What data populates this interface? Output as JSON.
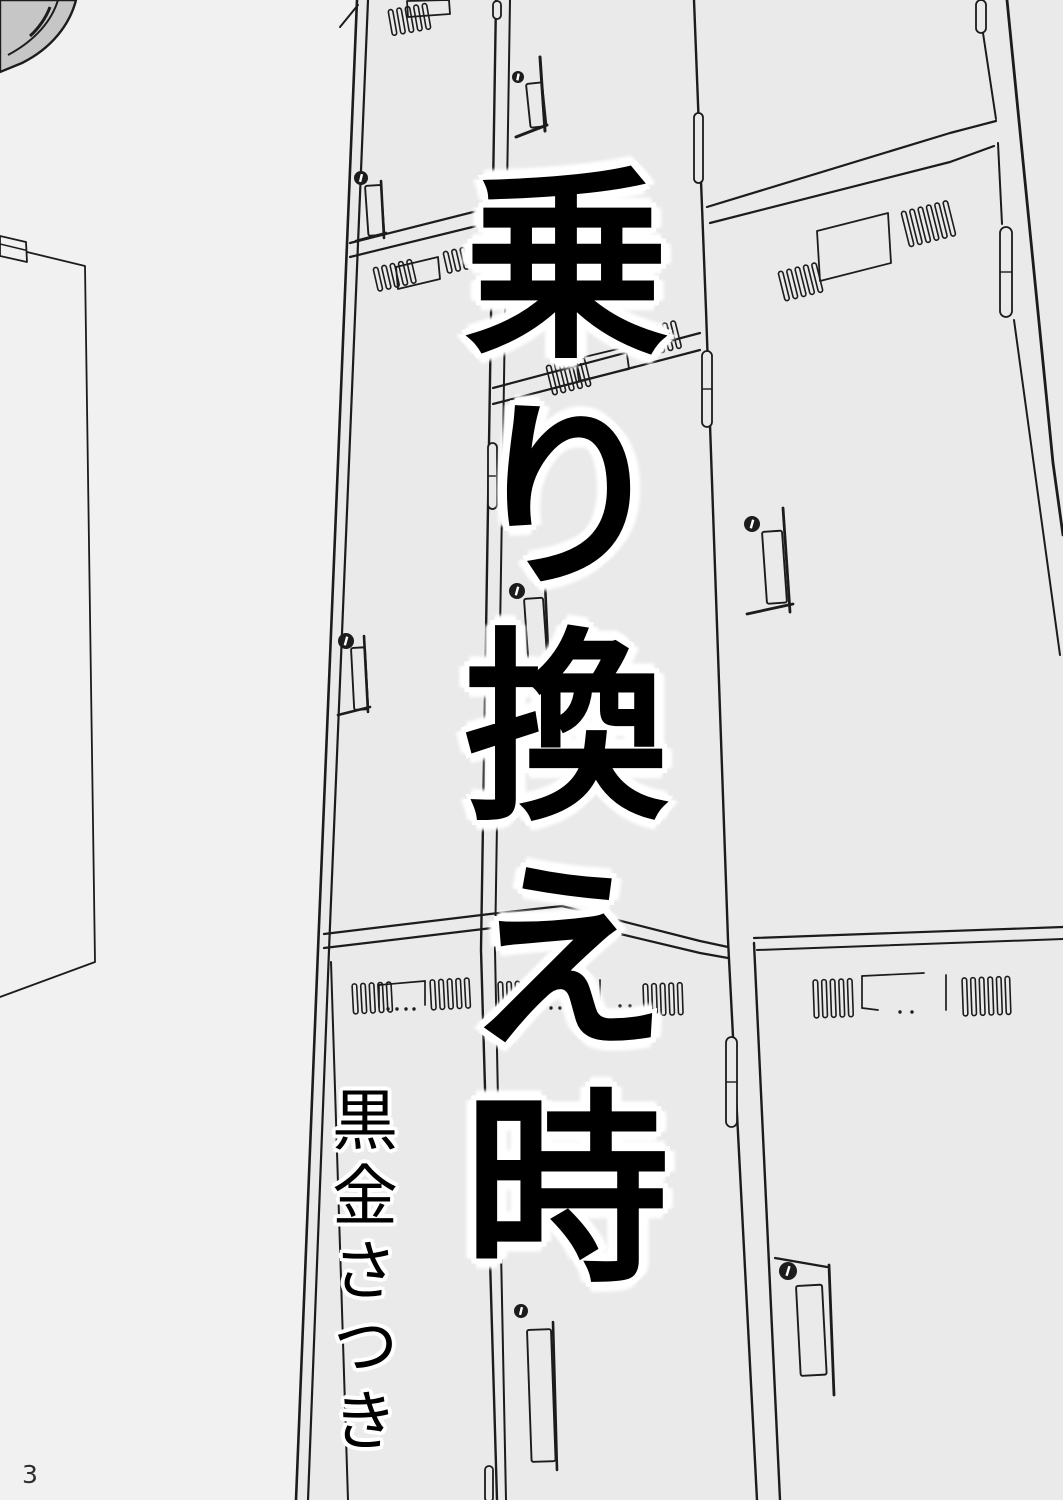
{
  "page_number": "3",
  "title": {
    "text": "乗り換え時"
  },
  "author": {
    "name": "黒金さつき"
  },
  "scene": {
    "background": "#f1f1f1",
    "bank_fill": "#eaeaea",
    "line": "#1c1c1c",
    "text_color": "#000000",
    "halo_color": "#ffffff",
    "fixture_fill": "#c6c6c6",
    "page_number_color": "#2f2f2f",
    "elements": [
      "ceiling-fixture-corner",
      "wall-door",
      "locker-bank",
      "locker-vents",
      "locker-name-plates",
      "locker-handles",
      "locker-keyholes"
    ]
  }
}
